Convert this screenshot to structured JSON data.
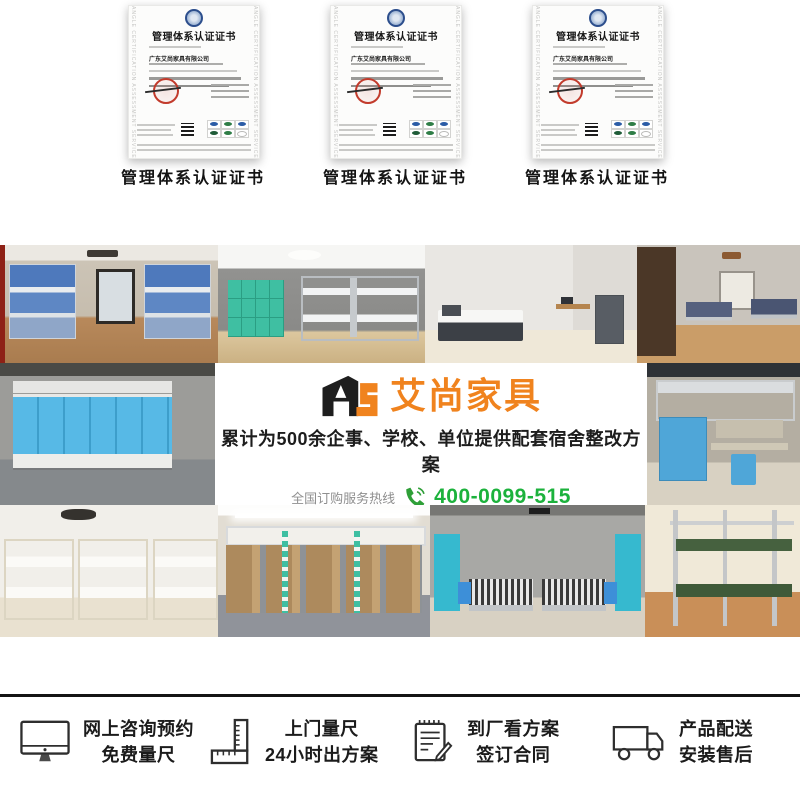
{
  "certificates": {
    "watermark": "ANGLE CERTIFICATION ASSESSMENT SERVICES",
    "items": [
      {
        "title": "管理体系认证证书",
        "company": "广东艾尚家具有限公司",
        "caption": "管理体系认证证书"
      },
      {
        "title": "管理体系认证证书",
        "company": "广东艾尚家具有限公司",
        "caption": "管理体系认证证书"
      },
      {
        "title": "管理体系认证证书",
        "company": "广东艾尚家具有限公司",
        "caption": "管理体系认证证书"
      }
    ]
  },
  "banner": {
    "logo_mark": "AS",
    "brand": "艾尚家具",
    "subtitle": "累计为500余企事、学校、单位提供配套宿舍整改方案",
    "hotline_label": "全国订购服务热线",
    "phone": "400-0099-515",
    "brand_color": "#F0831E",
    "phone_color": "#1CB23C"
  },
  "features": {
    "items": [
      {
        "icon": "monitor-icon",
        "line1": "网上咨询预约",
        "line2": "免费量尺"
      },
      {
        "icon": "ruler-icon",
        "line1": "上门量尺",
        "line2": "24小时出方案"
      },
      {
        "icon": "contract-icon",
        "line1": "到厂看方案",
        "line2": "签订合同"
      },
      {
        "icon": "truck-icon",
        "line1": "产品配送",
        "line2": "安装售后"
      }
    ]
  },
  "gallery": {
    "photos": [
      {
        "name": "blue-bunk-dorm"
      },
      {
        "name": "teal-lockers-bunk-room"
      },
      {
        "name": "single-bed-study-room"
      },
      {
        "name": "wood-floor-bunk-room"
      },
      {
        "name": "cyan-cabinet-dorm"
      },
      {
        "name": "loft-bed-desk-room"
      },
      {
        "name": "cream-bunk-room"
      },
      {
        "name": "loft-over-wardrobe-room"
      },
      {
        "name": "teal-wardrobe-twin-room"
      },
      {
        "name": "green-board-bunk-room"
      }
    ]
  }
}
